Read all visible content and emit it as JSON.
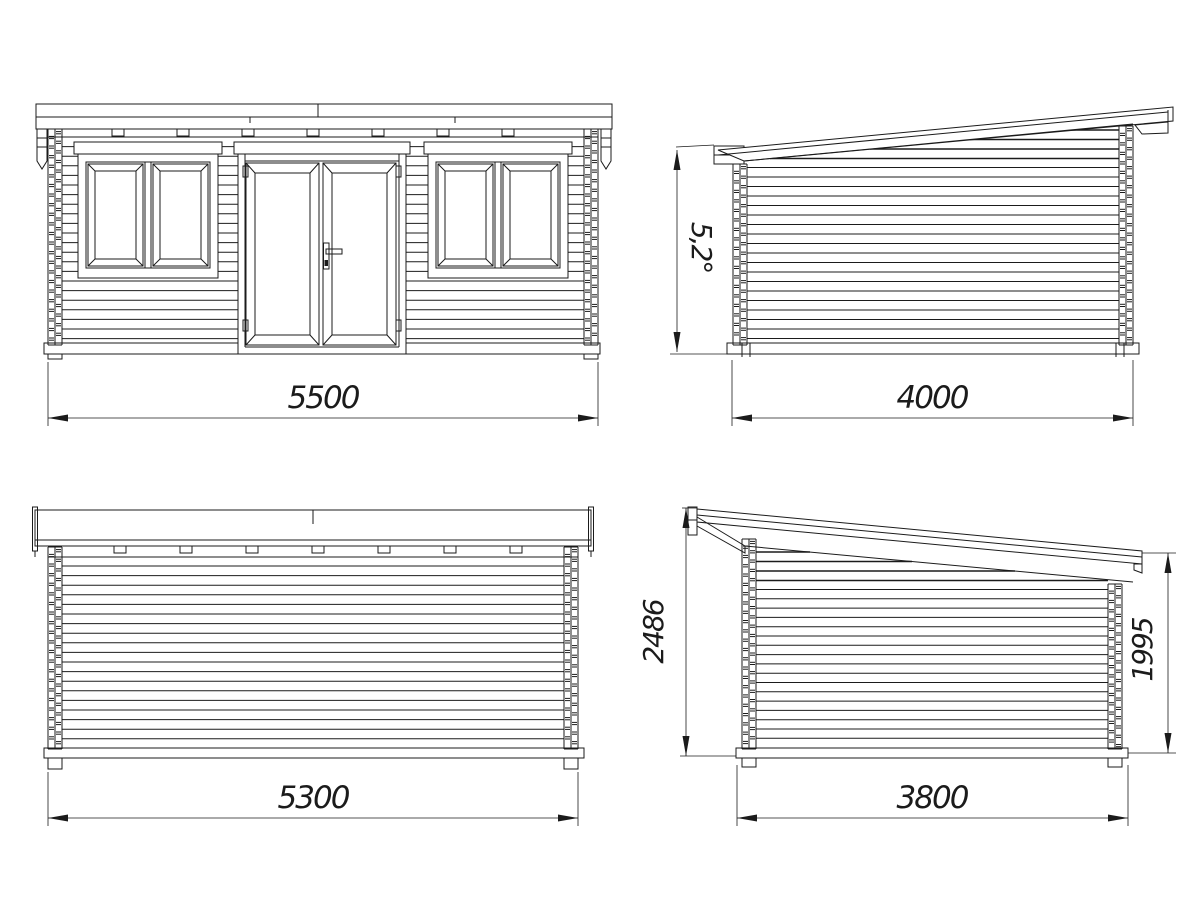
{
  "colors": {
    "background": "#ffffff",
    "line": "#1b1b1b"
  },
  "views": {
    "front": {
      "width_mm": "5500"
    },
    "side_right": {
      "roof_angle": "5,2°",
      "depth_mm": "4000"
    },
    "back": {
      "width_mm": "5300"
    },
    "side_left": {
      "height_high_mm": "2486",
      "height_low_mm": "1995",
      "depth_mm": "3800"
    }
  }
}
